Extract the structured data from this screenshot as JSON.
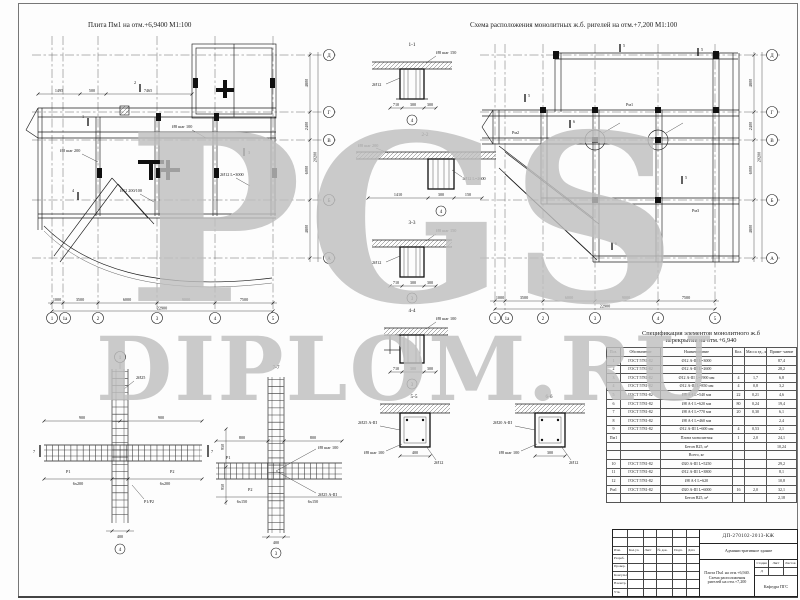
{
  "watermark": {
    "line1": "PGS",
    "line2": "DIPLOM.RU"
  },
  "plans": {
    "left": {
      "title": "Плита Пм1 на отм.+6,9400 М1:100",
      "bottom_axes": [
        "1",
        "1а",
        "2",
        "3",
        "4",
        "5"
      ],
      "side_axes": [
        "Д",
        "Г",
        "В",
        "Б",
        "А"
      ],
      "dims_top": [
        "1495",
        "500",
        "7465"
      ],
      "dims_bottom": [
        "1000",
        "3500",
        "6000",
        "9000",
        "7500"
      ],
      "dim_bottom_total": "22900",
      "dims_side": [
        "4800",
        "2400",
        "6000",
        "4800"
      ],
      "dim_side_total": "20200",
      "callouts": [
        "Ø8 шаг 200",
        "Ø8 шаг 100",
        "2Ø12 L=3000",
        "Ø12 200/100"
      ],
      "cut_marks": [
        "1",
        "2",
        "3",
        "4"
      ]
    },
    "right": {
      "title": "Схема расположения монолитных ж.б. ригелей на отм.+7,200 М1:100",
      "bottom_axes": [
        "1",
        "1а",
        "2",
        "3",
        "4",
        "5"
      ],
      "side_axes": [
        "Д",
        "Г",
        "В",
        "Б",
        "А"
      ],
      "dims_bottom": [
        "1000",
        "3500",
        "6000",
        "9000",
        "7500"
      ],
      "dim_bottom_total": "22900",
      "dims_side": [
        "4800",
        "2400",
        "6000",
        "4800"
      ],
      "dim_side_total": "20200",
      "beam_labels": [
        "Рм1",
        "Рм2",
        "Рм3"
      ],
      "cut_marks": [
        "5",
        "5",
        "5",
        "6",
        "5",
        "6"
      ]
    }
  },
  "sections": {
    "s11": {
      "title": "1-1",
      "dims": [
        "710",
        "300",
        "300"
      ],
      "axis": "4",
      "callouts": [
        "Ø8 шаг 150",
        "2Ø12"
      ]
    },
    "s22": {
      "title": "2-2",
      "dims": [
        "1410",
        "300",
        "150"
      ],
      "axis": "4",
      "callouts": [
        "Ø8 шаг 200",
        "1Ø12 L=2600"
      ]
    },
    "s33": {
      "title": "3-3",
      "dims": [
        "710",
        "300",
        "300"
      ],
      "axis": "3",
      "callouts": [
        "Ø8 шаг 150",
        "2Ø12"
      ]
    },
    "s44": {
      "title": "4-4",
      "dims": [
        "710",
        "300",
        "300"
      ],
      "axis": "3",
      "callouts": [
        "Ø8 шаг 100"
      ]
    },
    "s55": {
      "title": "5-5",
      "dims": [
        "400"
      ],
      "callouts": [
        "2Ø25 А-III",
        "Ø8 шаг 100",
        "2Ø12"
      ]
    },
    "s66": {
      "title": "6-6",
      "dims": [
        "300"
      ],
      "callouts": [
        "2Ø20 А-III",
        "Ø8 шаг 100",
        "2Ø12"
      ]
    }
  },
  "details": {
    "d1": {
      "axis_top": "1",
      "axis_bottom": "4",
      "dims_top": [
        "900",
        "900"
      ],
      "dims_bottom": [
        "6x200",
        "6x200"
      ],
      "dims_side": [
        "950",
        "950"
      ],
      "dim_col": "400",
      "labels": [
        "Р1",
        "Р2",
        "Р1/Р2",
        "2Ø25"
      ],
      "cut": "7"
    },
    "d77": {
      "title": "7-7",
      "axis_bottom": "3",
      "dims_top": [
        "800",
        "800"
      ],
      "dims_bottom": [
        "6x150",
        "6x150"
      ],
      "dim_col": "400",
      "labels": [
        "Ø8 шаг 100",
        "2Ø25 А-III",
        "Р1",
        "Р2"
      ]
    }
  },
  "spec_table": {
    "title_line1": "Спецификация элементов монолитного ж.б",
    "title_line2": "перекрытия на отм.+6,940",
    "headers": [
      "Поз.",
      "Обозначение",
      "Наименование",
      "Кол.",
      "Масса ед., кг",
      "Приме- чание"
    ],
    "rows": [
      [
        "1",
        "ГОСТ 5781-82",
        "Ø12 А-III L=3000",
        "",
        "",
        "87,4"
      ],
      [
        "2",
        "ГОСТ 5781-82",
        "Ø12 А-III L=2600",
        "",
        "",
        "28,2"
      ],
      [
        "3",
        "ГОСТ 5781-82",
        "Ø12 А-III L=1900 мм",
        "4",
        "1,7",
        "6,8"
      ],
      [
        "4",
        "ГОСТ 5781-82",
        "Ø12 А-III L=850 мм",
        "4",
        "0,8",
        "3,2"
      ],
      [
        "5",
        "ГОСТ 5781-82",
        "Ø8 А-I L=540 мм",
        "22",
        "0,21",
        "4,6"
      ],
      [
        "6",
        "ГОСТ 5781-82",
        "Ø8 А-I L=620 мм",
        "80",
        "0,24",
        "19,4"
      ],
      [
        "7",
        "ГОСТ 5781-82",
        "Ø8 А-I L=770 мм",
        "20",
        "0,30",
        "6,1"
      ],
      [
        "8",
        "ГОСТ 5781-82",
        "Ø8 А-I L=460 мм",
        "",
        "",
        "2,4"
      ],
      [
        "9",
        "ГОСТ 5781-82",
        "Ø12 А-III L=600 мм",
        "4",
        "0,53",
        "2,1"
      ],
      [
        "Пм1",
        "",
        "Плита монолитная",
        "1",
        "2,0",
        "24,1"
      ],
      [
        "",
        "",
        "Бетон В25, м³",
        "",
        "",
        "10,24"
      ],
      [
        "",
        "",
        "Всего, кг",
        "",
        "",
        ""
      ],
      [
        "10",
        "ГОСТ 5781-82",
        "Ø20 А-III L=5250",
        "",
        "",
        "29,2"
      ],
      [
        "11",
        "ГОСТ 5781-82",
        "Ø12 А-III L=3800",
        "",
        "",
        "8,1"
      ],
      [
        "12",
        "ГОСТ 5781-82",
        "Ø8 А-I L=620",
        "",
        "",
        "10,8"
      ],
      [
        "Рм1",
        "ГОСТ 5781-82",
        "Ø20 А-III L=6000",
        "16",
        "2,0",
        "32,1"
      ],
      [
        "",
        "",
        "Бетон В25, м³",
        "",
        "",
        "2,18"
      ]
    ]
  },
  "title_block": {
    "code": "ДП-270102-2013-КЖ",
    "object": "Административное здание",
    "sheet_name": "Плита Пм1 на отм.+6,940. Схема расположения ригелей на отм.+7,200",
    "org": "Кафедра ПГС",
    "stage": "Д",
    "sheet_no": "",
    "sheets_total": "",
    "mini_headers": [
      "Стадия",
      "Лист",
      "Листов"
    ],
    "header_cells": [
      "Изм.",
      "Кол.уч.",
      "Лист",
      "№ док.",
      "Подп.",
      "Дата"
    ],
    "row_labels": [
      "Разраб.",
      "Провер.",
      "Консульт.",
      "Н.контр.",
      "Утв."
    ]
  }
}
